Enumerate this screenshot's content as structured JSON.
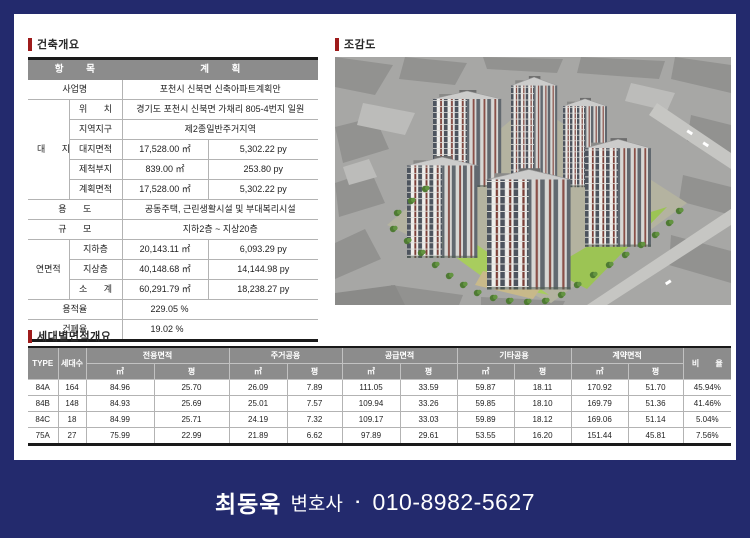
{
  "sections": {
    "building_overview_title": "건축개요",
    "rendering_title": "조감도",
    "unit_area_title": "세대별면적개요"
  },
  "building_overview": {
    "header": {
      "item": "항 목",
      "plan": "계 획"
    },
    "rows": {
      "project_name": {
        "label": "사업명",
        "value": "포천시 신북면 신축아파트계획안"
      },
      "site_group_label": "대 지",
      "location": {
        "label": "위 치",
        "value": "경기도 포천시 신북면 가채리 805-4번지 일원"
      },
      "zoning": {
        "label": "지역지구",
        "value": "제2종일반주거지역"
      },
      "site_area": {
        "label": "대지면적",
        "m2": "17,528.00 ㎡",
        "py": "5,302.22 py"
      },
      "excluded_site": {
        "label": "제척부지",
        "m2": "839.00 ㎡",
        "py": "253.80 py"
      },
      "planned_area": {
        "label": "계획면적",
        "m2": "17,528.00 ㎡",
        "py": "5,302.22 py"
      },
      "use": {
        "label": "용 도",
        "value": "공동주택, 근린생활시설 및 부대복리시설"
      },
      "scale": {
        "label": "규 모",
        "value": "지하2층 ~ 지상20층"
      },
      "floor_area_group_label": "연면적",
      "basement": {
        "label": "지하층",
        "m2": "20,143.11 ㎡",
        "py": "6,093.29 py"
      },
      "above_ground": {
        "label": "지상층",
        "m2": "40,148.68 ㎡",
        "py": "14,144.98 py"
      },
      "subtotal": {
        "label": "소 계",
        "m2": "60,291.79 ㎡",
        "py": "18,238.27 py"
      },
      "floor_area_ratio": {
        "label": "용적율",
        "value": "229.05 %"
      },
      "building_coverage": {
        "label": "건폐율",
        "value": "19.02 %"
      }
    }
  },
  "unit_area_table": {
    "headers": {
      "type": "TYPE",
      "households": "세대수",
      "exclusive": "전용면적",
      "residential_common": "주거공용",
      "supply": "공급면적",
      "other_common": "기타공용",
      "contract": "계약면적",
      "ratio": "비 율",
      "m2": "㎡",
      "py": "평"
    },
    "rows": [
      {
        "type": "84A",
        "households": "164",
        "ex_m2": "84.96",
        "ex_py": "25.70",
        "rc_m2": "26.09",
        "rc_py": "7.89",
        "su_m2": "111.05",
        "su_py": "33.59",
        "oc_m2": "59.87",
        "oc_py": "18.11",
        "ct_m2": "170.92",
        "ct_py": "51.70",
        "ratio": "45.94%"
      },
      {
        "type": "84B",
        "households": "148",
        "ex_m2": "84.93",
        "ex_py": "25.69",
        "rc_m2": "25.01",
        "rc_py": "7.57",
        "su_m2": "109.94",
        "su_py": "33.26",
        "oc_m2": "59.85",
        "oc_py": "18.10",
        "ct_m2": "169.79",
        "ct_py": "51.36",
        "ratio": "41.46%"
      },
      {
        "type": "84C",
        "households": "18",
        "ex_m2": "84.99",
        "ex_py": "25.71",
        "rc_m2": "24.19",
        "rc_py": "7.32",
        "su_m2": "109.17",
        "su_py": "33.03",
        "oc_m2": "59.89",
        "oc_py": "18.12",
        "ct_m2": "169.06",
        "ct_py": "51.14",
        "ratio": "5.04%"
      },
      {
        "type": "75A",
        "households": "27",
        "ex_m2": "75.99",
        "ex_py": "22.99",
        "rc_m2": "21.89",
        "rc_py": "6.62",
        "su_m2": "97.89",
        "su_py": "29.61",
        "oc_m2": "53.55",
        "oc_py": "16.20",
        "ct_m2": "151.44",
        "ct_py": "45.81",
        "ratio": "7.56%"
      }
    ]
  },
  "footer": {
    "name": "최동욱",
    "job_title": "변호사",
    "bullet": "▪",
    "phone": "010-8982-5627"
  },
  "colors": {
    "background_navy": "#232a6d",
    "accent_red": "#9e1b1b",
    "table_header_gray": "#8c8c8c"
  }
}
